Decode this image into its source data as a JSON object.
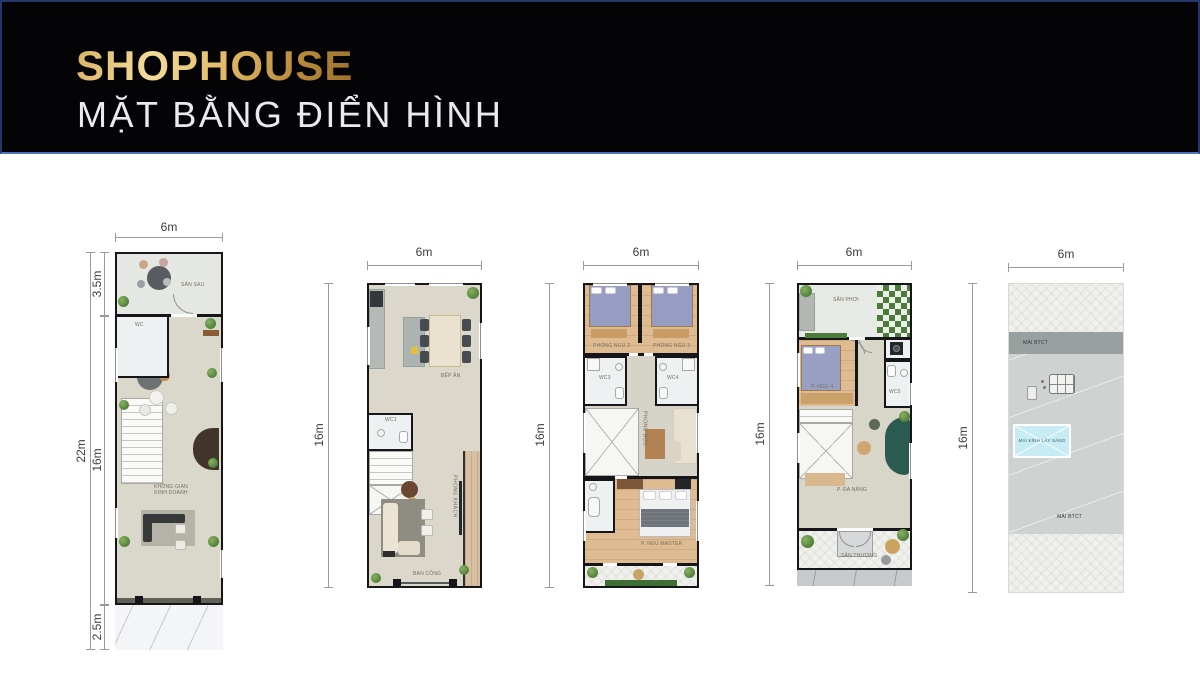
{
  "header": {
    "title": "SHOPHOUSE",
    "subtitle": "MẶT BẰNG ĐIỂN HÌNH"
  },
  "colors": {
    "title_gold": "#d8ab55",
    "header_bg": "#040406",
    "header_border_top": "#26376b",
    "header_border_bottom": "#4a72b8",
    "wall_black": "#15151a",
    "skylight_blue": "#c7ecf5",
    "trellis_green": "#4c7c3c",
    "teal_sofa": "#2b5a50"
  },
  "plans": [
    {
      "id": "floor-1",
      "dim_width": "6m",
      "dim_total_height": "22m",
      "dim_back": "3.5m",
      "dim_main": "16m",
      "dim_front": "2.5m",
      "rooms": {
        "san_sau": "SÂN SAU",
        "wc": "WC",
        "business_1": "KHÔNG GIAN",
        "business_2": "KINH DOANH"
      }
    },
    {
      "id": "floor-2",
      "dim_width": "6m",
      "dim_height": "16m",
      "rooms": {
        "bep_an": "BẾP ĂN",
        "wc1": "WC1",
        "phong_khach": "PHÒNG KHÁCH",
        "ban_cong": "BAN CÔNG"
      }
    },
    {
      "id": "floor-3",
      "dim_width": "6m",
      "dim_height": "16m",
      "rooms": {
        "phong_ngu_2": "PHÒNG NGỦ 2",
        "phong_ngu_3": "PHÒNG NGỦ 3",
        "wc3": "WC3",
        "wc4": "WC4",
        "phong_doc": "PHÒNG ĐỌC",
        "ngu_master": "P. NGỦ MASTER"
      }
    },
    {
      "id": "floor-4",
      "dim_width": "6m",
      "dim_height": "16m",
      "rooms": {
        "san_phoi": "SÂN PHƠI",
        "p_ngu_4": "P. NGỦ 4",
        "wc5": "WC5",
        "da_nang": "P. ĐA NĂNG",
        "san_thuong": "SÂN THƯỢNG"
      }
    },
    {
      "id": "roof",
      "dim_width": "6m",
      "dim_height": "16m",
      "rooms": {
        "mai_btct_top": "MÁI BTCT",
        "mai_kinh": "MÁI KÍNH LẤY SÁNG",
        "mai_btct_bottom": "MÁI BTCT"
      }
    }
  ]
}
